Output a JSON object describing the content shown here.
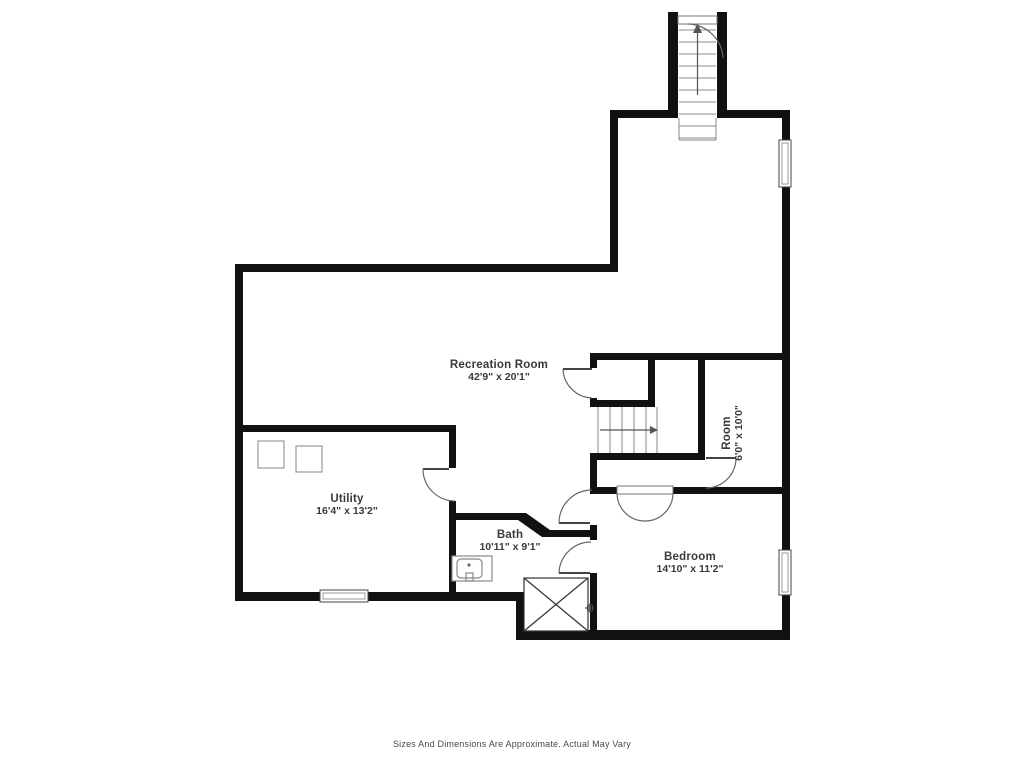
{
  "title": "Basement Floor Plan",
  "rooms": {
    "recreation": {
      "name": "Recreation Room",
      "dimensions": "42'9\" x 20'1\""
    },
    "utility": {
      "name": "Utility",
      "dimensions": "16'4\" x 13'2\""
    },
    "bath": {
      "name": "Bath",
      "dimensions": "10'11\" x 9'1\""
    },
    "bedroom": {
      "name": "Bedroom",
      "dimensions": "14'10\" x 11'2\""
    },
    "room": {
      "name": "Room",
      "dimensions": "6'0\" x 10'0\""
    }
  },
  "footer": {
    "disclaimer": "Sizes And Dimensions Are Approximate. Actual May Vary"
  },
  "colors": {
    "wall": "#111111",
    "fixture_line": "#777777",
    "door_arc": "#666666",
    "text": "#3a3a3a",
    "background": "#ffffff"
  }
}
